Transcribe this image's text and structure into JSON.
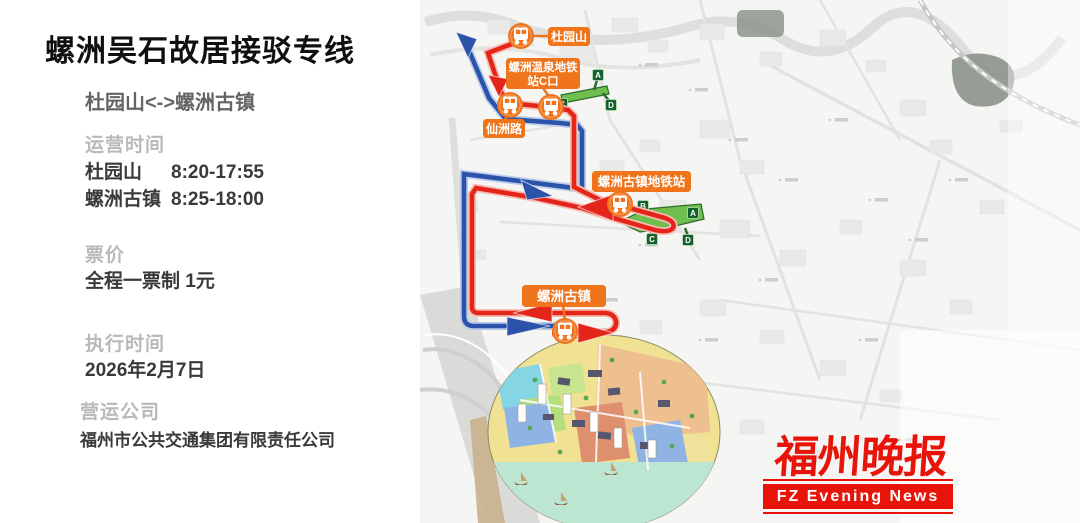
{
  "panel": {
    "title": "螺洲吴石故居接驳专线",
    "route": "杜园山<->螺洲古镇",
    "hours_label": "运营时间",
    "schedule": [
      {
        "stop": "杜园山",
        "time": "8:20-17:55"
      },
      {
        "stop": "螺洲古镇",
        "time": "8:25-18:00"
      }
    ],
    "fare_label": "票价",
    "fare_value": "全程一票制 1元",
    "effective_label": "执行时间",
    "effective_value": "2026年2月7日",
    "operator_label": "营运公司",
    "operator_value": "福州市公共交通集团有限责任公司"
  },
  "map": {
    "stops": [
      {
        "label": "杜园山"
      },
      {
        "label_line1": "螺洲温泉地铁",
        "label_line2": "站C口"
      },
      {
        "label": "仙洲路"
      },
      {
        "label": "螺洲古镇地铁站"
      },
      {
        "label": "螺洲古镇"
      }
    ],
    "stations": [
      {
        "name": "螺洲温泉地铁站",
        "exits": [
          "A",
          "C",
          "D"
        ]
      },
      {
        "name": "螺洲古镇地铁站",
        "exits": [
          "B",
          "A",
          "C",
          "D"
        ]
      }
    ],
    "colors": {
      "route_red": "#E4251A",
      "route_blue": "#2B53A9",
      "stop_orange": "#F0741B",
      "station_green": "#6FBF4E"
    }
  },
  "logo": {
    "cn": "福州晚报",
    "en": "FZ Evening News",
    "color": "#E8140A"
  }
}
